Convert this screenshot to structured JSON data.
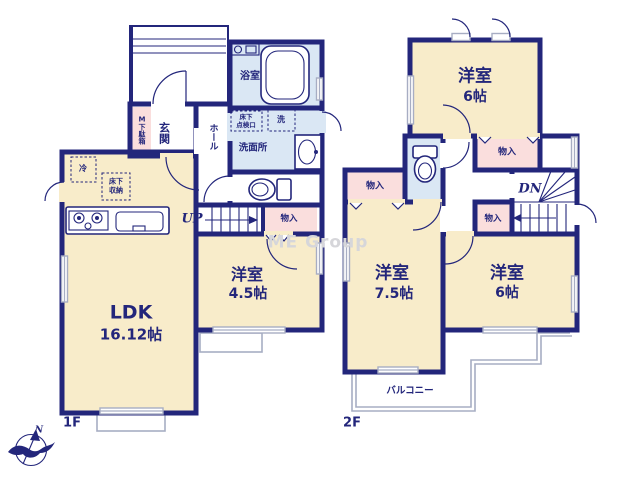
{
  "colors": {
    "wall": "#23267b",
    "room": "#f8ecca",
    "wet": "#dae7f4",
    "closet": "#fadedd",
    "line": "#a7adc3",
    "text": "#23267b",
    "watermark": "#d6d6da"
  },
  "watermark": "ME Group",
  "compass": {
    "north": "N"
  },
  "floor1": {
    "label": "1F",
    "ldk": {
      "name": "LDK",
      "area": "16.12帖"
    },
    "bedroom": {
      "name": "洋室",
      "area": "4.5帖"
    },
    "entrance": "玄関",
    "hall": "ホール",
    "bathroom": "浴室",
    "washroom": "洗面所",
    "shoe_box": "M下駄箱",
    "fridge": "冷",
    "floor_storage_line1": "床下",
    "floor_storage_line2": "収納",
    "floor_hatch_line1": "床下",
    "floor_hatch_line2": "点検口",
    "washer": "洗",
    "closet": "物入",
    "stairs_up": "UP"
  },
  "floor2": {
    "label": "2F",
    "bedroom_north": {
      "name": "洋室",
      "area": "6帖"
    },
    "bedroom_sw": {
      "name": "洋室",
      "area": "7.5帖"
    },
    "bedroom_se": {
      "name": "洋室",
      "area": "6帖"
    },
    "closet_west": "物入",
    "closet_north": "物入",
    "closet_mid": "物入",
    "stairs_down": "DN",
    "balcony": "バルコニー"
  }
}
